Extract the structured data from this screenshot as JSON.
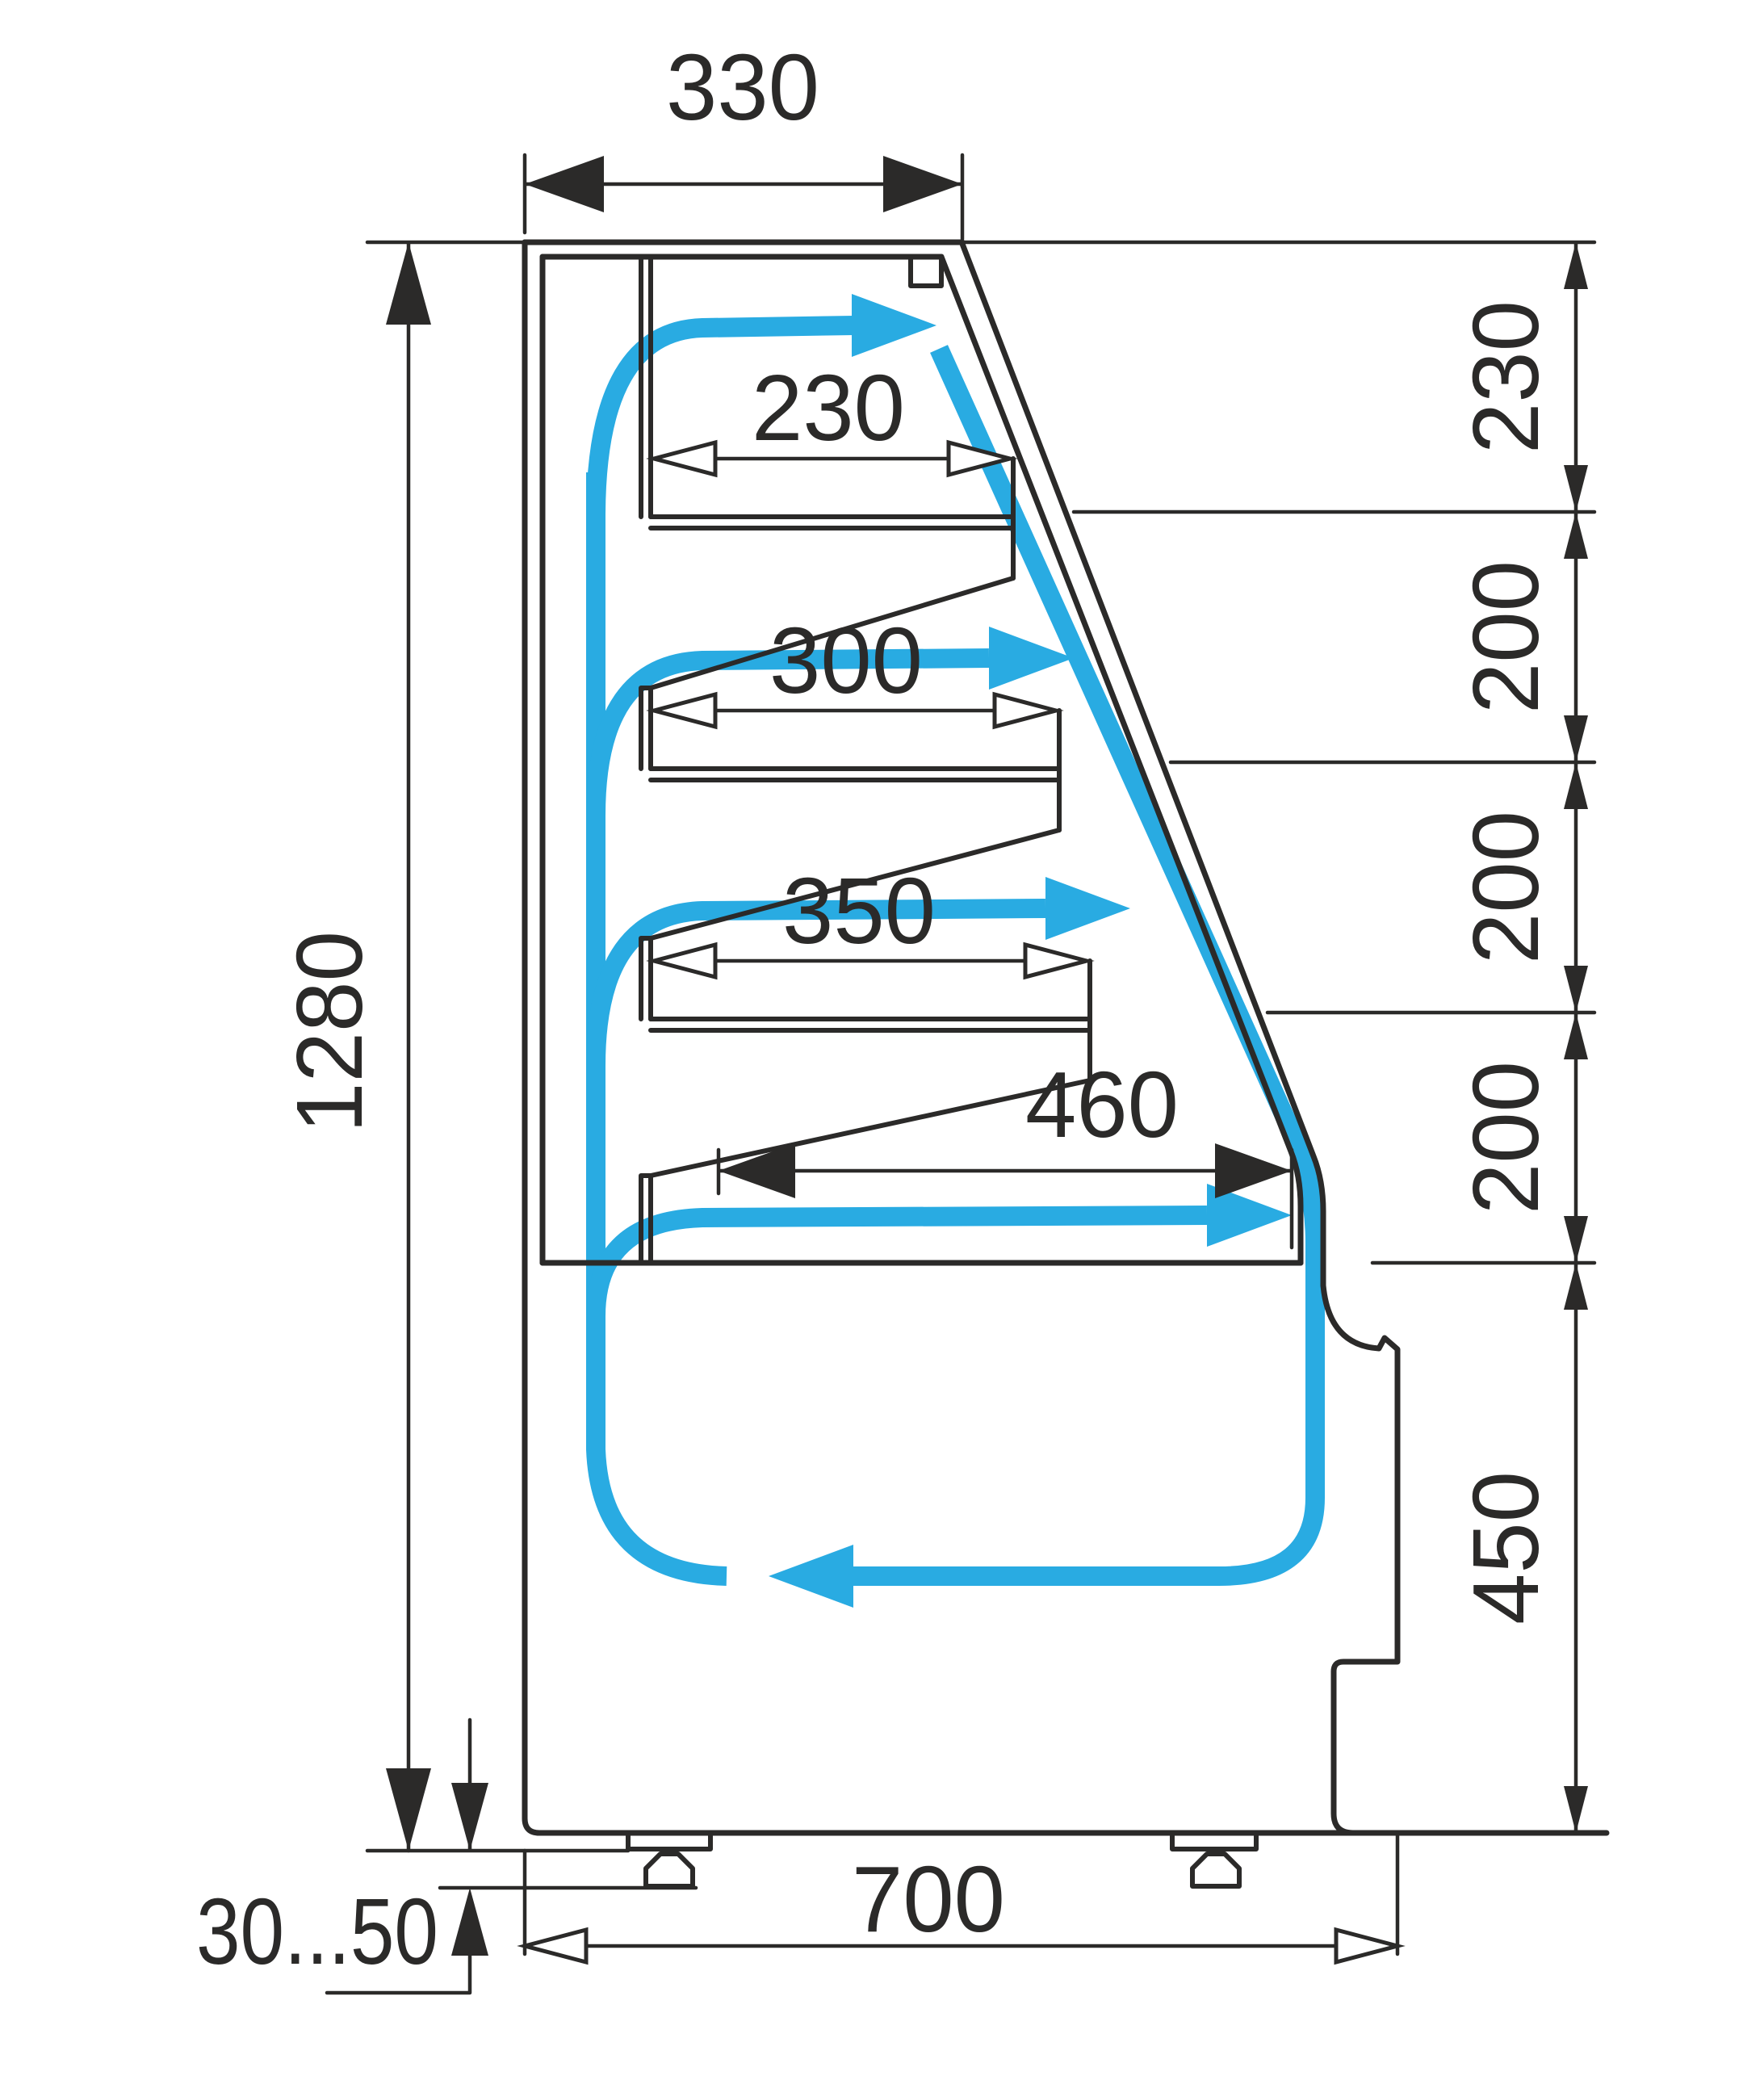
{
  "drawing": {
    "type": "technical-cross-section",
    "subject": "refrigerated display case side section with air circulation",
    "unit": "mm",
    "dimensions": {
      "top_depth": {
        "value": "330",
        "meaning": "canopy top depth"
      },
      "shelf1_depth": {
        "value": "230",
        "meaning": "top shelf depth"
      },
      "shelf2_depth": {
        "value": "300",
        "meaning": "second shelf depth"
      },
      "shelf3_depth": {
        "value": "350",
        "meaning": "third shelf depth"
      },
      "deck_depth": {
        "value": "460",
        "meaning": "bottom deck depth"
      },
      "overall_height": {
        "value": "1280",
        "meaning": "overall body height"
      },
      "section_top": {
        "value": "230",
        "meaning": "canopy to shelf 1 spacing"
      },
      "section_2": {
        "value": "200",
        "meaning": "shelf 1 to shelf 2 spacing"
      },
      "section_3": {
        "value": "200",
        "meaning": "shelf 2 to shelf 3 spacing"
      },
      "section_4": {
        "value": "200",
        "meaning": "shelf 3 to deck spacing"
      },
      "base_height": {
        "value": "450",
        "meaning": "deck to case bottom"
      },
      "overall_depth": {
        "value": "700",
        "meaning": "overall case depth"
      },
      "leg_adjustment": {
        "value": "30...50",
        "meaning": "adjustable foot height range"
      }
    },
    "colors": {
      "line": "#2b2a29",
      "airflow": "#29abe2",
      "background": "#ffffff"
    },
    "airflow_arrows": [
      "riser-up-back-duct",
      "over-shelf-1-right",
      "over-shelf-2-right",
      "over-shelf-3-right",
      "over-deck-right",
      "down-front-glass",
      "bottom-return-left"
    ]
  }
}
